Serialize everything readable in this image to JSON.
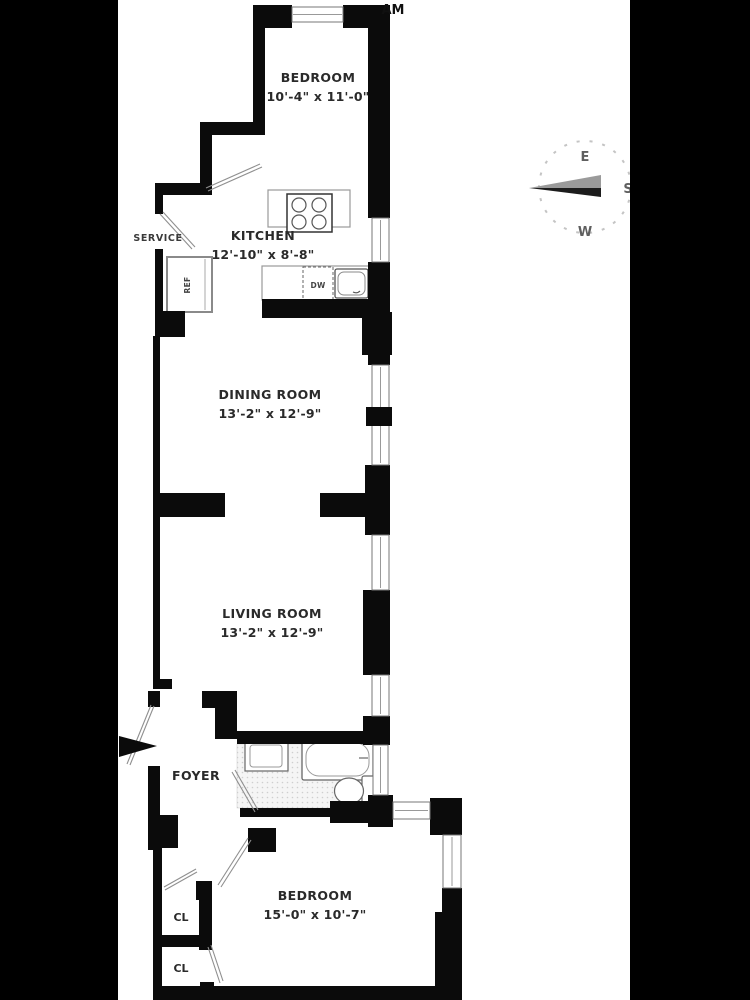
{
  "watermark": {
    "text": "AM"
  },
  "rooms": {
    "bedroom_top": {
      "name": "BEDROOM",
      "dims": "10'-4\" x 11'-0\""
    },
    "kitchen": {
      "name": "KITCHEN",
      "dims": "12'-10\" x 8'-8\""
    },
    "dining_room": {
      "name": "DINING ROOM",
      "dims": "13'-2\" x 12'-9\""
    },
    "living_room": {
      "name": "LIVING ROOM",
      "dims": "13'-2\" x 12'-9\""
    },
    "foyer": {
      "name": "FOYER"
    },
    "bedroom_bottom": {
      "name": "BEDROOM",
      "dims": "15'-0\" x 10'-7\""
    },
    "service": {
      "name": "SERVICE"
    },
    "closet_1": {
      "name": "CL"
    },
    "closet_2": {
      "name": "CL"
    }
  },
  "fixtures": {
    "refrigerator": "REF",
    "dishwasher": "DW"
  },
  "compass": {
    "east": "E",
    "south": "S",
    "west": "W"
  },
  "colors": {
    "wall": "#0b0b0b",
    "plan_background": "#ffffff",
    "letterbox": "#000000",
    "thin_line": "#8f8f8f",
    "label_text": "#2a2a2a"
  }
}
